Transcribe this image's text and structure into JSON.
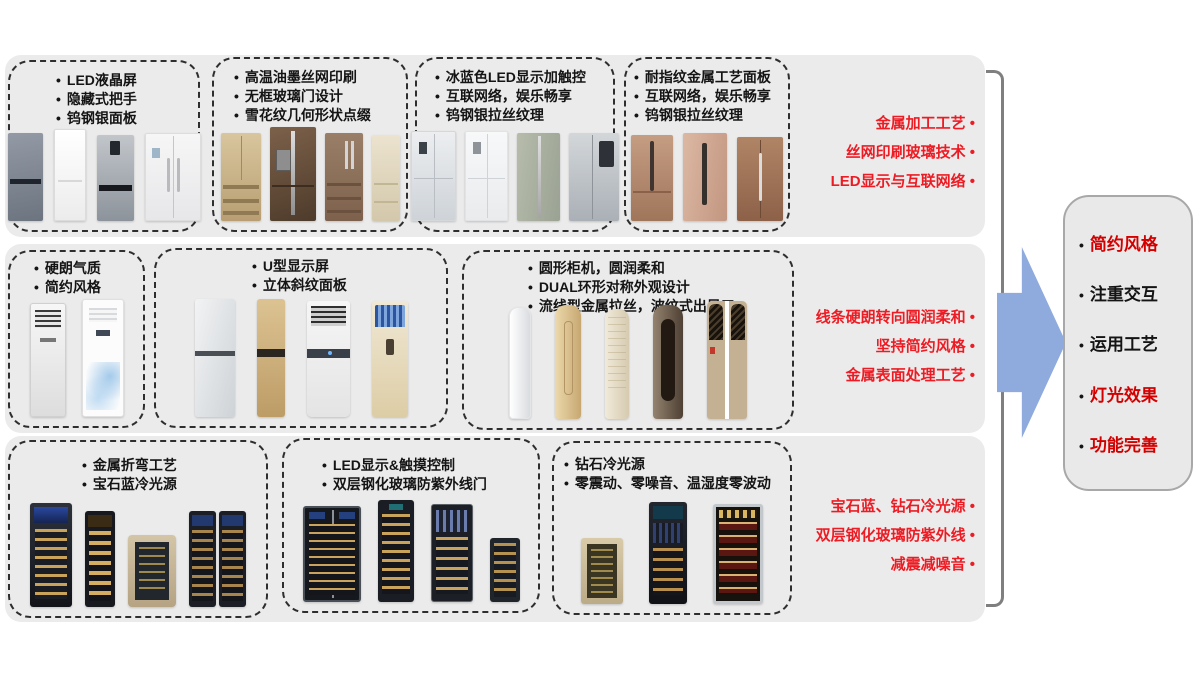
{
  "rows": [
    {
      "boxes": [
        {
          "bullets": [
            "LED液晶屏",
            "隐藏式把手",
            "钨钢银面板"
          ]
        },
        {
          "bullets": [
            "高温油墨丝网印刷",
            "无框玻璃门设计",
            "雪花纹几何形状点缀"
          ]
        },
        {
          "bullets": [
            "冰蓝色LED显示加触控",
            "互联网络，娱乐畅享",
            "钨钢银拉丝纹理"
          ]
        },
        {
          "bullets": [
            "耐指纹金属工艺面板",
            "互联网络，娱乐畅享",
            "钨钢银拉丝纹理"
          ]
        }
      ],
      "annotations": [
        "金属加工工艺",
        "丝网印刷玻璃技术",
        "LED显示与互联网络"
      ]
    },
    {
      "boxes": [
        {
          "bullets": [
            "硬朗气质",
            "简约风格"
          ]
        },
        {
          "bullets": [
            "U型显示屏",
            "立体斜纹面板"
          ]
        },
        {
          "bullets": [
            "圆形柜机，圆润柔和",
            "DUAL环形对称外观设计",
            "流线型金属拉丝，波纹式出风口"
          ]
        }
      ],
      "annotations": [
        "线条硬朗转向圆润柔和",
        "坚持简约风格",
        "金属表面处理工艺"
      ]
    },
    {
      "boxes": [
        {
          "bullets": [
            "金属折弯工艺",
            "宝石蓝冷光源"
          ]
        },
        {
          "bullets": [
            "LED显示&触摸控制",
            "双层钢化玻璃防紫外线门"
          ]
        },
        {
          "bullets": [
            "钻石冷光源",
            "零震动、零噪音、温湿度零波动"
          ]
        }
      ],
      "annotations": [
        "宝石蓝、钻石冷光源",
        "双层钢化玻璃防紫外线",
        "减震减噪音"
      ]
    }
  ],
  "summary": {
    "items": [
      {
        "label": "简约风格"
      },
      {
        "label": "注重交互"
      },
      {
        "label": "运用工艺"
      },
      {
        "label": "灯光效果"
      },
      {
        "label": "功能完善"
      }
    ]
  },
  "colors": {
    "annotation_red": "#ed1c24",
    "summary_red": "#d40000",
    "arrow_blue": "#8faadc",
    "panel_gray": "#ebebeb",
    "bracket_gray": "#7f7f7f"
  }
}
